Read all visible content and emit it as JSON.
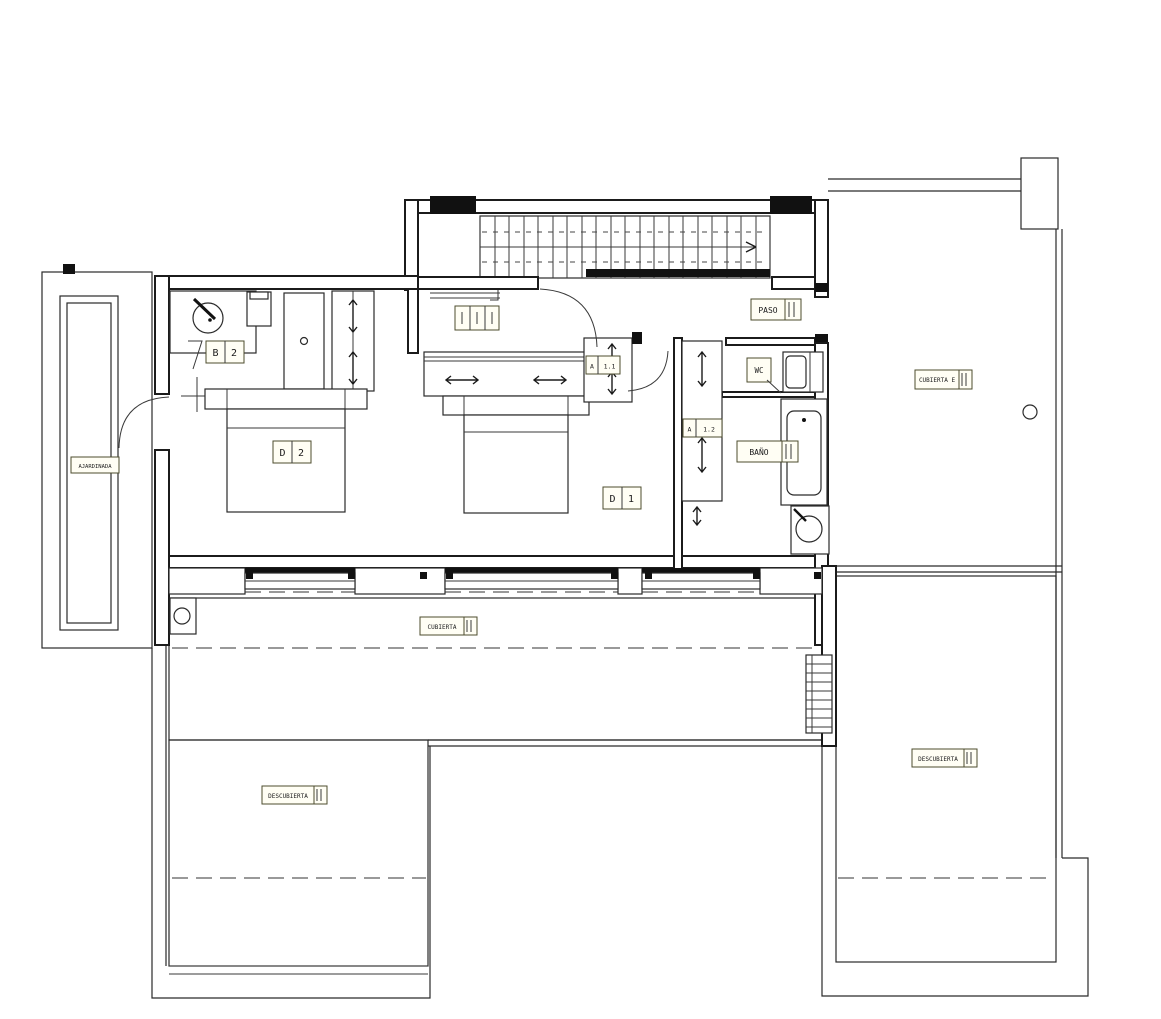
{
  "plan": {
    "room_labels": {
      "paso": "PASO",
      "wc": "WC",
      "bano": "BAÑO",
      "bano2": {
        "letter": "B",
        "number": "2"
      },
      "dormitorio2": {
        "letter": "D",
        "number": "2"
      },
      "dormitorio1": {
        "letter": "D",
        "number": "1"
      },
      "armario_1_1": {
        "letter": "A",
        "number": "1.1"
      },
      "armario_1_2": {
        "letter": "A",
        "number": "1.2"
      }
    },
    "terrace_labels": {
      "cubierta_centro": "CUBIERTA",
      "cubierta_este": "CUBIERTA E",
      "descubierta_izquierda": "DESCUBIERTA",
      "descubierta_derecha": "DESCUBIERTA",
      "ajardinada": "AJARDINADA"
    },
    "colors": {
      "line": "#1b1b1b",
      "tile_joint": "#555555",
      "label_border": "#4c4c2e",
      "paper": "#ffffff"
    }
  }
}
